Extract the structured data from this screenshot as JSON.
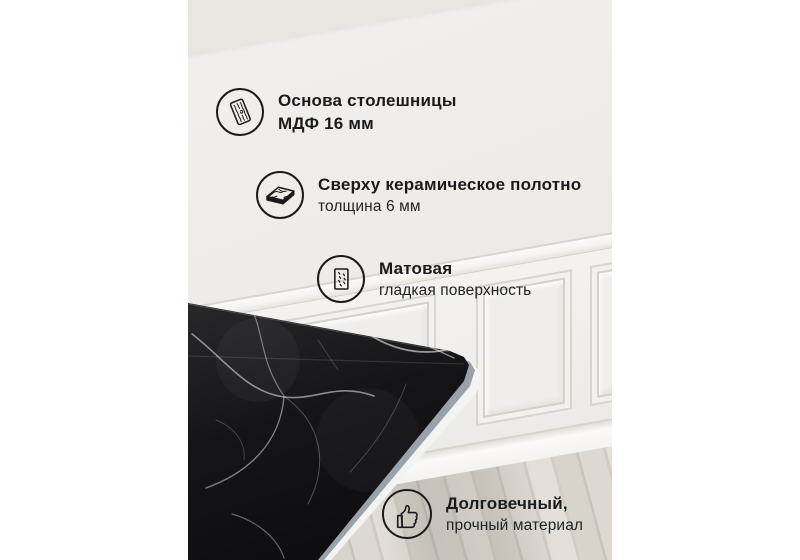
{
  "card": {
    "callouts": [
      {
        "icon": "mdf-board-icon",
        "title": "Основа столешницы",
        "subtitle": "МДФ 16 мм"
      },
      {
        "icon": "ceramic-slab-icon",
        "title": "Сверху керамическое полотно",
        "subtitle": "толщина 6 мм"
      },
      {
        "icon": "matte-surface-icon",
        "title": "Матовая",
        "subtitle": "гладкая поверхность"
      },
      {
        "icon": "thumbs-up-icon",
        "title": "Долговечный,",
        "subtitle": "прочный материал"
      }
    ],
    "colors": {
      "canvas": "#ffffff",
      "text": "#1b1b1d",
      "icon_stroke": "#1b1b1d",
      "wall": "#eceae6",
      "marble": "#0e0e11",
      "marble_vein": "#ffffff",
      "table_edge": "#9aa2ac",
      "floor_light": "#e4e0d9",
      "floor_dark": "#cfcbc3"
    }
  }
}
